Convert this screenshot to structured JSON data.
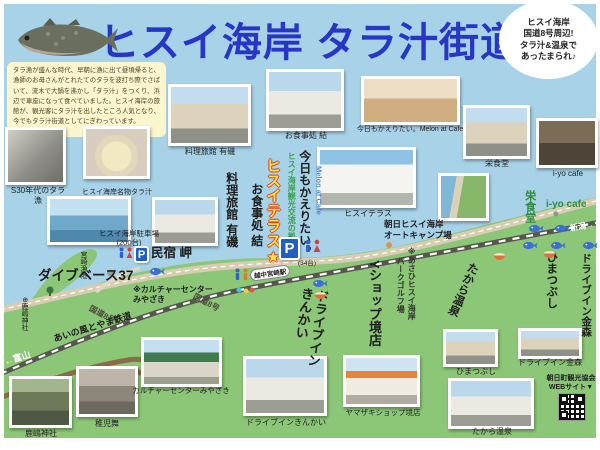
{
  "header": {
    "title": "ヒスイ海岸 タラ汁街道",
    "badge": "ヒスイ海岸\n国道8号周辺!\nタラ汁&温泉で\nあったまられ♪"
  },
  "intro": "タラ漁が盛んな時代、早朝に漁に出て昼頃帰ると、漁師のお母さんがとれたてのタラを波打ち際でさばいて、流木で大鍋を沸かし「タラ汁」をつくり、浜辺で車座になって食べていました。ヒスイ海岸の旅館が、観光客にタラ汁を出したところ人気となり、今でもタラ汁街道としてにぎわっています。",
  "photos": {
    "s30": "S30年代のタラ漁",
    "tarajiru": "ヒスイ海岸名物タラ汁",
    "ariso": "料理旅館 有磯",
    "yui": "お食事処 結",
    "melon": "今日もかえりたい。Melon at Cafe",
    "sakae": "栄食堂",
    "iyo": "i-yo cafe",
    "terrace": "ヒスイテラス",
    "kashima": "鹿嶋神社",
    "chigomai": "稚児舞",
    "culture": "カルチャーセンターみやざき",
    "kinkai": "ドライブインきんかい",
    "yamazaki": "ヤマザキショップ境店",
    "himatsubushi": "ひまつぶし",
    "takara": "たから温泉",
    "kanamori": "ドライブイン金森"
  },
  "map": {
    "pois": {
      "dive_base37": "ダイブベース37",
      "minshuku_misaki": "民宿 岬",
      "miyazaki_port": "宮崎漁港",
      "kashima_shrine": "⊕鹿嶋神社",
      "culture_center": "※カルチャーセンター\nみやざき",
      "hisui_parking": "ヒスイ海岸駐車場\n(200台)",
      "terrace_parking_count": "(34台)",
      "hisui_terrace": "ヒスイテラス★",
      "terrace_tagline": "ヒスイ海岸観光交流の拠点",
      "kyomo_kaeritai": "今日もかえりたい。",
      "melon_at_cafe": "Melon at Cafe",
      "oshokuji_yui": "お食事処 結",
      "ryokan_ariso": "料理旅館 有磯",
      "autocamp": "朝日ヒスイ海岸\nオートキャンプ場",
      "park_golf_1": "※あさひヒスイ海岸",
      "park_golf_2": "パークゴルフ場",
      "y_shop": "Yショップ境店",
      "drivein_kinkai": "ドライブイン\nきんかい",
      "himatsubushi": "ひまつぶし",
      "takara_onsen": "たから温泉",
      "drivein_kanamori": "ドライブイン金森",
      "sakae_shokudo": "栄食堂",
      "iyo_cafe": "i-yo cafe"
    },
    "roads": {
      "route8": "国道8号",
      "railway": "あいの風とやま鉄道",
      "to_toyama": "←富山",
      "to_niigata": "新潟→",
      "station": "越中宮崎駅"
    },
    "parking_label": "P"
  },
  "footer": {
    "org": "朝日町観光協会",
    "web": "WEBサイト▼"
  },
  "colors": {
    "title_blue": "#2836c8",
    "sea_blue": "#a8d2e8",
    "land_green": "#8cc777",
    "accent_yellow": "#ffe042"
  }
}
